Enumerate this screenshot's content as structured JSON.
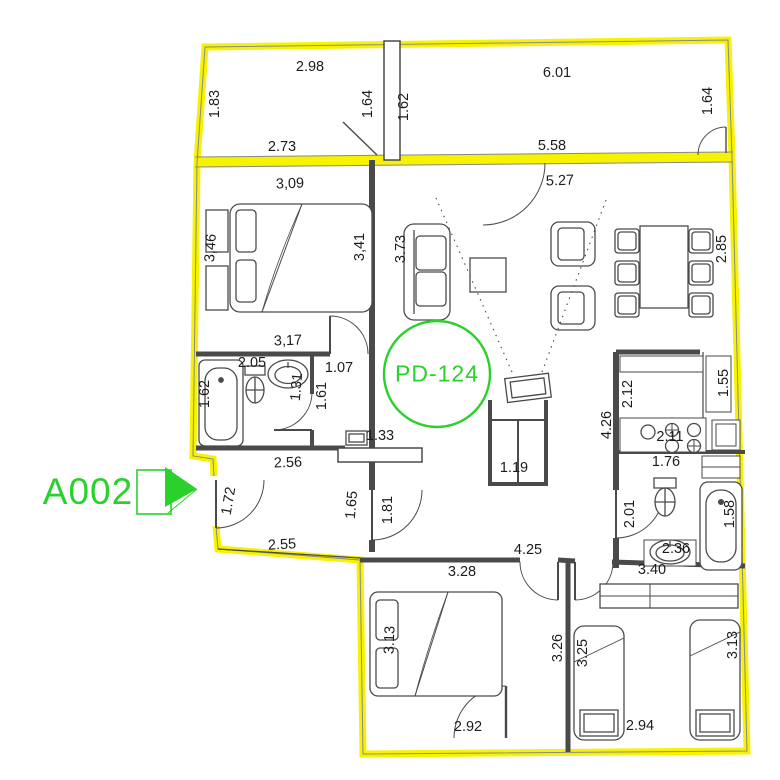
{
  "plan": {
    "unit_entrance_label": "A002",
    "unit_code": "PD-124",
    "colors": {
      "boundary_yellow": "#f6f200",
      "label_green": "#2bd12b",
      "wall_dark": "#4a4a4a",
      "dim_text": "#1c1c1c"
    },
    "labels": [
      {
        "id": "balcony-left-top",
        "text": "2.98",
        "x": 310,
        "y": 67,
        "rot": 0
      },
      {
        "id": "balcony-right-top",
        "text": "6.01",
        "x": 557,
        "y": 73,
        "rot": 0
      },
      {
        "id": "balcony-left-side-left",
        "text": "1.83",
        "x": 215,
        "y": 104,
        "rot": -90
      },
      {
        "id": "balcony-left-side-right",
        "text": "1.64",
        "x": 368,
        "y": 104,
        "rot": -90
      },
      {
        "id": "balcony-right-side-left",
        "text": "1.62",
        "x": 404,
        "y": 107,
        "rot": -90
      },
      {
        "id": "balcony-right-side-right",
        "text": "1.64",
        "x": 708,
        "y": 101,
        "rot": -90
      },
      {
        "id": "balcony-left-bottom",
        "text": "2.73",
        "x": 282,
        "y": 147,
        "rot": 0
      },
      {
        "id": "balcony-right-bottom",
        "text": "5.58",
        "x": 552,
        "y": 146,
        "rot": 0
      },
      {
        "id": "bedroom1-top",
        "text": "3,09",
        "x": 290,
        "y": 184,
        "rot": -2
      },
      {
        "id": "living-top",
        "text": "5.27",
        "x": 560,
        "y": 181,
        "rot": -2
      },
      {
        "id": "bedroom1-left",
        "text": "3,46",
        "x": 211,
        "y": 248,
        "rot": -86
      },
      {
        "id": "bedroom1-right",
        "text": "3,41",
        "x": 360,
        "y": 247,
        "rot": -90
      },
      {
        "id": "living-left",
        "text": "3.73",
        "x": 401,
        "y": 249,
        "rot": -90
      },
      {
        "id": "dining-right",
        "text": "2.85",
        "x": 722,
        "y": 249,
        "rot": -90
      },
      {
        "id": "bedroom1-bottom",
        "text": "3,17",
        "x": 288,
        "y": 341,
        "rot": -2
      },
      {
        "id": "bath1-top",
        "text": "2.05",
        "x": 252,
        "y": 363,
        "rot": 0
      },
      {
        "id": "bath1-tub",
        "text": "1.62",
        "x": 205,
        "y": 394,
        "rot": -90
      },
      {
        "id": "bath1-sink",
        "text": "1.31",
        "x": 297,
        "y": 387,
        "rot": -85
      },
      {
        "id": "corridor1-length",
        "text": "1.61",
        "x": 322,
        "y": 396,
        "rot": -90
      },
      {
        "id": "corridor1-width",
        "text": "1.07",
        "x": 339,
        "y": 368,
        "rot": 0
      },
      {
        "id": "hall-cabinet",
        "text": "1.33",
        "x": 380,
        "y": 436,
        "rot": 0
      },
      {
        "id": "hall-top",
        "text": "2.56",
        "x": 288,
        "y": 463,
        "rot": -2
      },
      {
        "id": "tv-unit-width",
        "text": "1.19",
        "x": 514,
        "y": 468,
        "rot": 0
      },
      {
        "id": "kitchen-left",
        "text": "2.12",
        "x": 628,
        "y": 394,
        "rot": -90
      },
      {
        "id": "kitchen-wall",
        "text": "4.26",
        "x": 607,
        "y": 425,
        "rot": -90
      },
      {
        "id": "kitchen-right",
        "text": "1.55",
        "x": 724,
        "y": 383,
        "rot": -90
      },
      {
        "id": "kitchen-counter",
        "text": "2.11",
        "x": 670,
        "y": 437,
        "rot": 0
      },
      {
        "id": "wc-width",
        "text": "1.76",
        "x": 666,
        "y": 462,
        "rot": 0
      },
      {
        "id": "entry-door",
        "text": "1.72",
        "x": 229,
        "y": 501,
        "rot": -80
      },
      {
        "id": "hall-left",
        "text": "1.65",
        "x": 352,
        "y": 505,
        "rot": -85
      },
      {
        "id": "hall-door",
        "text": "1.81",
        "x": 388,
        "y": 510,
        "rot": -90
      },
      {
        "id": "hall-bottom",
        "text": "2.55",
        "x": 282,
        "y": 545,
        "rot": -3
      },
      {
        "id": "bath2-left",
        "text": "2.01",
        "x": 630,
        "y": 514,
        "rot": -90
      },
      {
        "id": "bath2-tub",
        "text": "1.58",
        "x": 730,
        "y": 514,
        "rot": -90
      },
      {
        "id": "bath2-sink",
        "text": "2.36",
        "x": 676,
        "y": 549,
        "rot": 0
      },
      {
        "id": "bedroom3-top",
        "text": "3.40",
        "x": 652,
        "y": 570,
        "rot": 0
      },
      {
        "id": "bottom-corridor",
        "text": "4.25",
        "x": 528,
        "y": 550,
        "rot": 0
      },
      {
        "id": "bedroom2-top",
        "text": "3.28",
        "x": 462,
        "y": 572,
        "rot": 0
      },
      {
        "id": "bedroom2-bed",
        "text": "3.13",
        "x": 390,
        "y": 640,
        "rot": -88
      },
      {
        "id": "bedroom2-right",
        "text": "3.26",
        "x": 558,
        "y": 648,
        "rot": -90
      },
      {
        "id": "bedroom3-left",
        "text": "3.25",
        "x": 583,
        "y": 653,
        "rot": -90
      },
      {
        "id": "bedroom3-bed",
        "text": "3.13",
        "x": 733,
        "y": 645,
        "rot": -90
      },
      {
        "id": "bedroom2-bottom",
        "text": "2.92",
        "x": 468,
        "y": 727,
        "rot": 0
      },
      {
        "id": "bedroom3-bottom",
        "text": "2.94",
        "x": 640,
        "y": 726,
        "rot": 0
      }
    ]
  }
}
